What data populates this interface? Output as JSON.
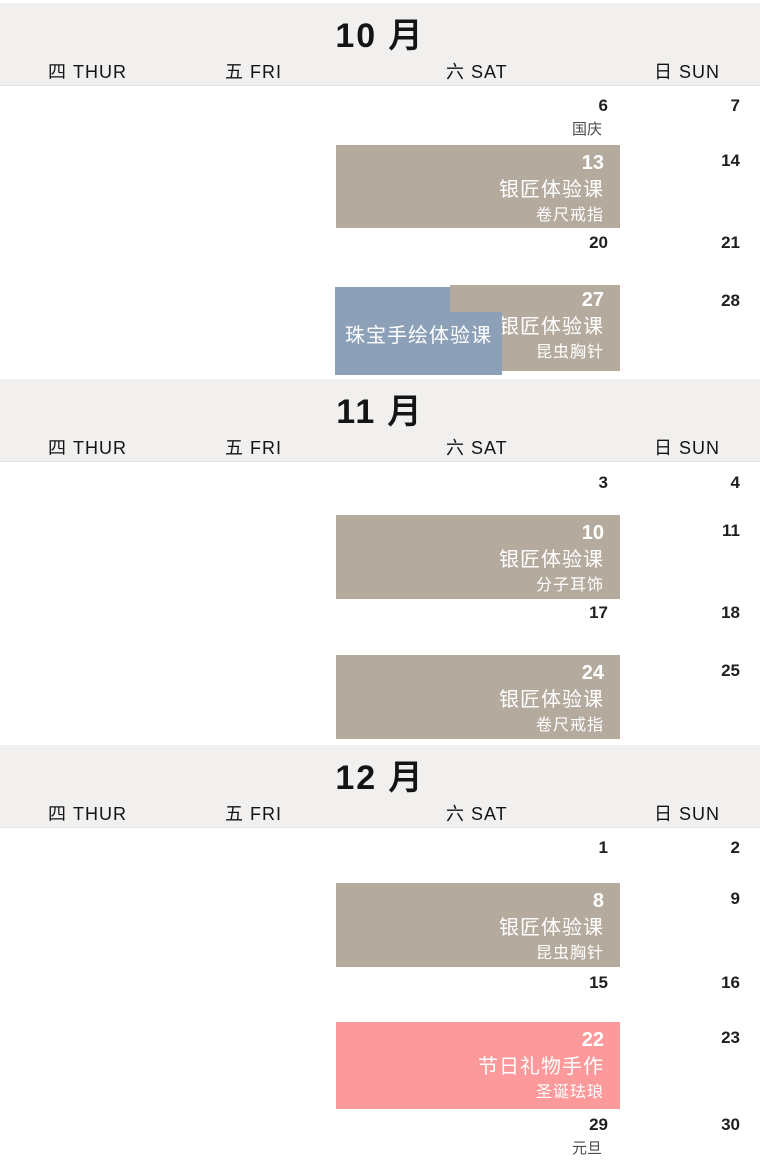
{
  "colors": {
    "band_bg": "#f1f0ee",
    "event_tan": "#b4aa9d",
    "event_blue": "#8ca0b8",
    "event_pink": "#fc999b",
    "event_text": "#ffffff",
    "date_color": "#1f1f1f",
    "holiday_color": "#4a4a4a"
  },
  "weekday_header": {
    "thur": "四 THUR",
    "fri": "五 FRI",
    "sat": "六 SAT",
    "sun": "日 SUN"
  },
  "months": [
    {
      "title": "10 月",
      "weeks": [
        {
          "sat_date": "6",
          "sat_holiday": "国庆",
          "sun_date": "7"
        },
        {
          "event": {
            "date": "13",
            "title": "银匠体验课",
            "subtitle": "卷尺戒指"
          },
          "sun_date": "14"
        },
        {
          "sat_date": "20",
          "sun_date": "21"
        },
        {
          "event": {
            "date": "27",
            "title": "银匠体验课",
            "subtitle": "昆虫胸针"
          },
          "overlay": {
            "title": "珠宝手绘体验课"
          },
          "sun_date": "28"
        }
      ]
    },
    {
      "title": "11 月",
      "weeks": [
        {
          "sat_date": "3",
          "sun_date": "4"
        },
        {
          "event": {
            "date": "10",
            "title": "银匠体验课",
            "subtitle": "分子耳饰"
          },
          "sun_date": "11"
        },
        {
          "sat_date": "17",
          "sun_date": "18"
        },
        {
          "event": {
            "date": "24",
            "title": "银匠体验课",
            "subtitle": "卷尺戒指"
          },
          "sun_date": "25"
        }
      ]
    },
    {
      "title": "12 月",
      "weeks": [
        {
          "sat_date": "1",
          "sun_date": "2"
        },
        {
          "event": {
            "date": "8",
            "title": "银匠体验课",
            "subtitle": "昆虫胸针"
          },
          "sun_date": "9"
        },
        {
          "sat_date": "15",
          "sun_date": "16"
        },
        {
          "event": {
            "date": "22",
            "title": "节日礼物手作",
            "subtitle": "圣诞珐琅"
          },
          "sun_date": "23"
        },
        {
          "sat_date": "29",
          "sat_holiday": "元旦",
          "sun_date": "30"
        }
      ]
    }
  ]
}
